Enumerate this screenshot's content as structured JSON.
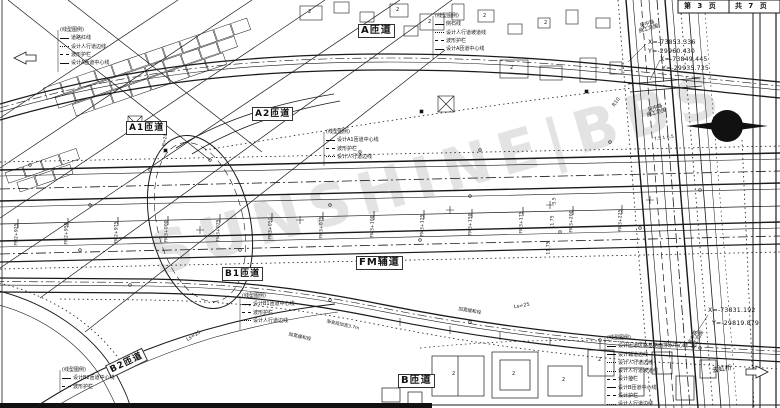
{
  "title_block": {
    "page": "第 3 页",
    "pages_total": "共 7 页"
  },
  "watermark": "SUNSHINE|BBS",
  "ramps": {
    "a": "A匝道",
    "a1": "A1匝道",
    "a2": "A2匝道",
    "b1": "B1匝道",
    "b2": "B2匝道",
    "b": "B匝道",
    "fm": "FM辅道"
  },
  "coords": {
    "p1x": "X=-73853.336",
    "p1y": "Y=-29960.430",
    "p2x": "X=-73849.445",
    "p2y": "Y=-29935.735",
    "p3x": "X=-73831.192",
    "p3y": "Y=-29819.879"
  },
  "legends": {
    "topleft": {
      "title": "(线型图例)",
      "items": [
        "道路红线",
        "设计人行道边线",
        "波形护栏",
        "设计A匝道中心线"
      ]
    },
    "a": {
      "title": "(线型图例)",
      "items": [
        "侧石线",
        "设计人行道坡道线",
        "波形护栏",
        "设计A匝道中心线"
      ]
    },
    "a1": {
      "title": "(线型图例)",
      "items": [
        "设计A1匝道中心线",
        "波形护栏",
        "设计人行道边线"
      ]
    },
    "b1": {
      "title": "(线型图例)",
      "items": [
        "设计B1匝道中心线",
        "波形护栏",
        "设计人行道边线"
      ]
    },
    "b2": {
      "title": "(线型图例)",
      "items": [
        "设计B2匝道中心线",
        "波形护栏"
      ]
    },
    "right": {
      "title": "(线型图例)",
      "items": [
        "设计匝道区路基路面排水中心线",
        "设计辅道边线",
        "设计人行道边线",
        "设计人行道坡道线",
        "设计护栏",
        "设计B匝道中心线",
        "设计护栏",
        "设计人行道边线"
      ]
    }
  },
  "chainage": {
    "labels": [
      "FM2+925",
      "FM2+950",
      "FM2+975",
      "FM3+000",
      "FM3+025",
      "FM3+050",
      "FM3+075",
      "FM3+100",
      "FM3+125",
      "FM3+150",
      "FM3+175",
      "FM3+200",
      "FM3+225"
    ]
  },
  "dims": {
    "d1": "3.5",
    "d2": "11.75",
    "d3": "11.75",
    "lanes": "7.5 1 6.5"
  },
  "annotations": {
    "r10": "R10",
    "r20": "R=20",
    "ls25_a": "Ls=25",
    "ls25_b": "Ls=25",
    "widen_a": "加宽缓和段",
    "widen_b": "加宽缓和段",
    "taper": "渐变段加宽3.7m",
    "construction_road": "吴中路",
    "construction_scope": "施工范围",
    "direction": "去虹桥"
  },
  "buildings": {
    "story": "2"
  },
  "colors": {
    "line": "#1a1a1a",
    "watermark": "#c9c9c9",
    "paper": "#ffffff"
  }
}
